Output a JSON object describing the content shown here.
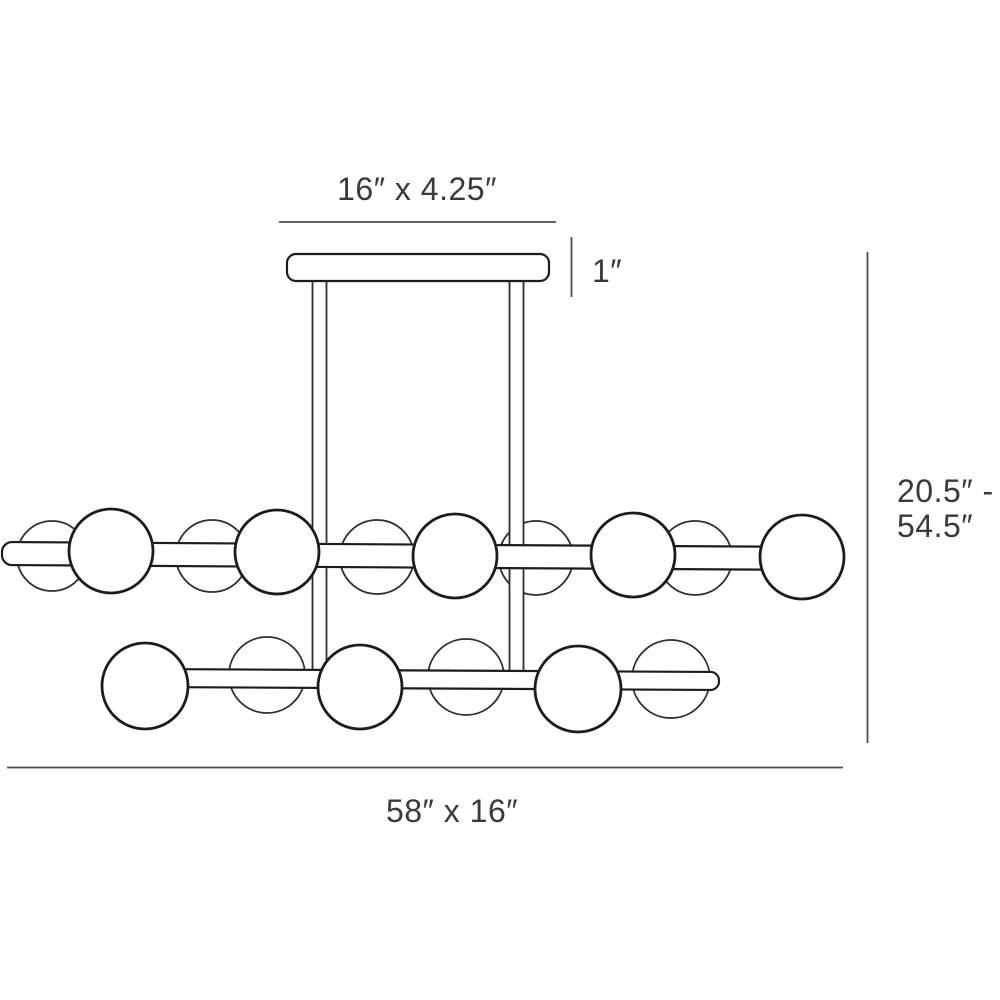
{
  "labels": {
    "canopy_size": "16″ x 4.25″",
    "canopy_height": "1″",
    "height_range_line1": "20.5″ -",
    "height_range_line2": "54.5″",
    "fixture_size": "58″ x 16″"
  },
  "dimensions": {
    "canopy_width_in": 16,
    "canopy_depth_in": 4.25,
    "canopy_height_in": 1,
    "fixture_width_in": 58,
    "fixture_depth_in": 16,
    "overall_height_min_in": 20.5,
    "overall_height_max_in": 54.5
  },
  "style": {
    "background": "#ffffff",
    "fixture_stroke": "#1c1c1c",
    "secondary_stroke": "#2e2e2e",
    "dimension_stroke": "#4f4f4f",
    "label_color": "#3a3a3a"
  },
  "geometry": {
    "dimension_lines": [
      {
        "name": "canopy-width-dim-line",
        "x1": 279,
        "y1": 222,
        "x2": 556,
        "y2": 222
      },
      {
        "name": "canopy-height-dim-line",
        "x1": 571.5,
        "y1": 237,
        "x2": 571.5,
        "y2": 297
      },
      {
        "name": "overall-height-dim-line",
        "x1": 867.5,
        "y1": 252,
        "x2": 867.5,
        "y2": 743
      },
      {
        "name": "fixture-width-dim-line",
        "x1": 7,
        "y1": 767.5,
        "x2": 843,
        "y2": 767.5
      }
    ],
    "canopy": {
      "x": 287,
      "y": 254,
      "width": 262,
      "height": 27,
      "radius": 9
    },
    "stems": [
      {
        "name": "stem-left",
        "x": 312.5,
        "y": 277,
        "width": 14,
        "height": 397
      },
      {
        "name": "stem-right",
        "x": 509.5,
        "y": 277,
        "width": 14,
        "height": 398
      }
    ],
    "rod_arms": [
      {
        "name": "rod-arm-upper",
        "x": 2,
        "y": 542,
        "width": 803,
        "height": 23,
        "radius": 10,
        "tilt_deg": 0.35
      },
      {
        "name": "rod-arm-lower",
        "x": 148,
        "y": 669,
        "width": 571,
        "height": 18,
        "radius": 8.5,
        "tilt_deg": 0.3
      }
    ],
    "behind_globes": [
      {
        "cx": 52,
        "cy": 556,
        "r": 35
      },
      {
        "cx": 212,
        "cy": 556,
        "r": 36
      },
      {
        "cx": 377,
        "cy": 557,
        "r": 37
      },
      {
        "cx": 536,
        "cy": 558,
        "r": 37
      },
      {
        "cx": 695,
        "cy": 558,
        "r": 37
      },
      {
        "cx": 267,
        "cy": 675,
        "r": 38
      },
      {
        "cx": 466,
        "cy": 677,
        "r": 38
      },
      {
        "cx": 671,
        "cy": 679,
        "r": 39
      }
    ],
    "front_globes": [
      {
        "cx": 111,
        "cy": 551,
        "r": 42
      },
      {
        "cx": 277,
        "cy": 552,
        "r": 42
      },
      {
        "cx": 455,
        "cy": 556,
        "r": 42
      },
      {
        "cx": 633,
        "cy": 555,
        "r": 42
      },
      {
        "cx": 802,
        "cy": 557,
        "r": 42
      },
      {
        "cx": 145,
        "cy": 686,
        "r": 43
      },
      {
        "cx": 360,
        "cy": 687,
        "r": 42
      },
      {
        "cx": 578,
        "cy": 689,
        "r": 43
      }
    ]
  }
}
